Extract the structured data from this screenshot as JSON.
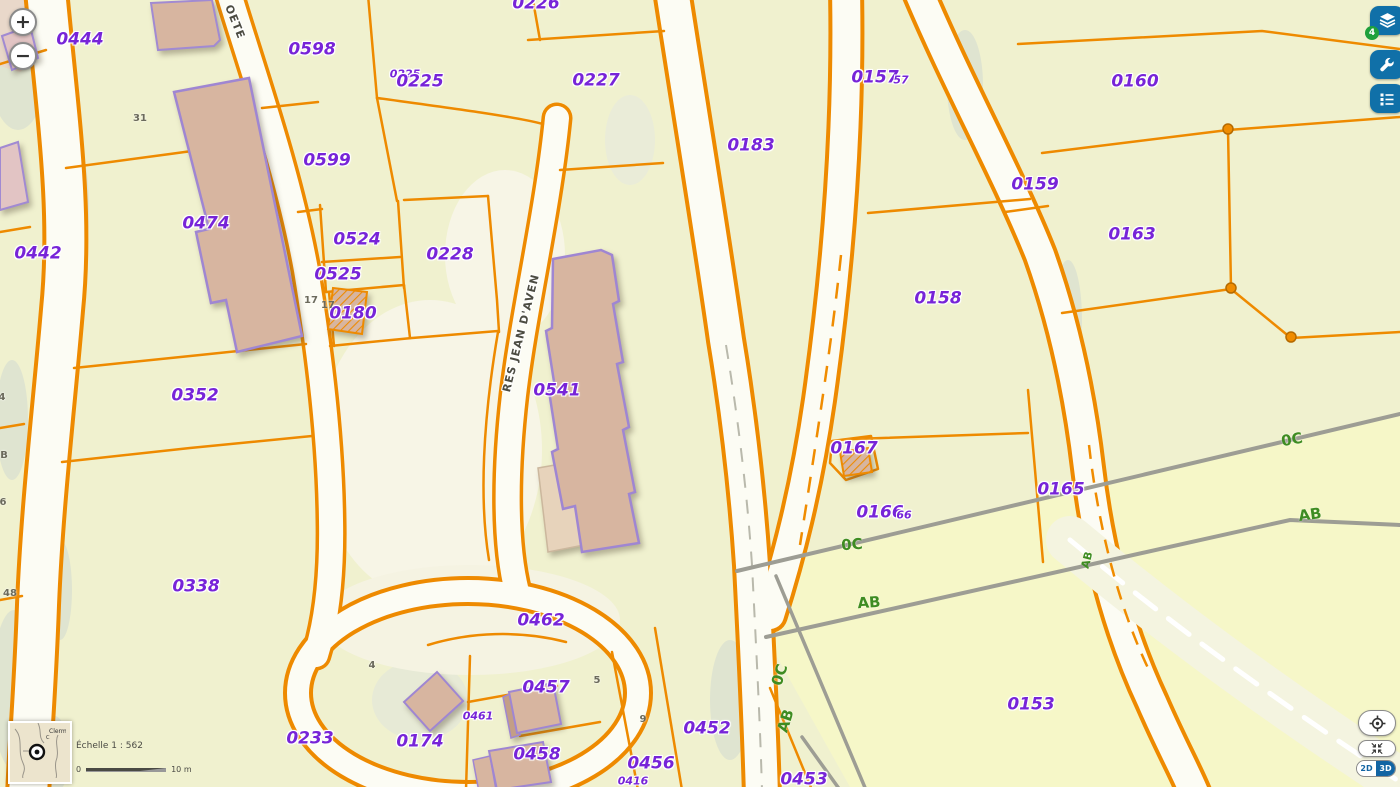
{
  "map": {
    "background": "#f0f1cf",
    "parcel_line_color": "#ee8a00",
    "parcel_label_color": "#7724d8",
    "section_label_color": "#3e8c22",
    "building_fill": "#d7b5a0",
    "building_outline": "#9f86d2",
    "section_line_color": "#9d9d94",
    "labels": [
      {
        "t": "0444",
        "x": 80,
        "y": 40,
        "k": "p"
      },
      {
        "t": "0598",
        "x": 312,
        "y": 50,
        "k": "p"
      },
      {
        "t": "0226",
        "x": 536,
        "y": 4,
        "k": "p"
      },
      {
        "t": "0225",
        "x": 405,
        "y": 74,
        "k": "ps"
      },
      {
        "t": "0225",
        "x": 420,
        "y": 82,
        "k": "p"
      },
      {
        "t": "0227",
        "x": 596,
        "y": 81,
        "k": "p"
      },
      {
        "t": "0157",
        "x": 875,
        "y": 78,
        "k": "p"
      },
      {
        "t": "57",
        "x": 901,
        "y": 80,
        "k": "ps"
      },
      {
        "t": "0160",
        "x": 1135,
        "y": 82,
        "k": "p"
      },
      {
        "t": "0183",
        "x": 751,
        "y": 146,
        "k": "p"
      },
      {
        "t": "0599",
        "x": 327,
        "y": 161,
        "k": "p"
      },
      {
        "t": "0159",
        "x": 1035,
        "y": 185,
        "k": "p"
      },
      {
        "t": "0474",
        "x": 206,
        "y": 224,
        "k": "p"
      },
      {
        "t": "0163",
        "x": 1132,
        "y": 235,
        "k": "p"
      },
      {
        "t": "0524",
        "x": 357,
        "y": 240,
        "k": "p"
      },
      {
        "t": "0228",
        "x": 450,
        "y": 255,
        "k": "p"
      },
      {
        "t": "0525",
        "x": 338,
        "y": 275,
        "k": "p"
      },
      {
        "t": "0158",
        "x": 938,
        "y": 299,
        "k": "p"
      },
      {
        "t": "0180",
        "x": 353,
        "y": 314,
        "k": "p"
      },
      {
        "t": "0442",
        "x": 38,
        "y": 254,
        "k": "p"
      },
      {
        "t": "0352",
        "x": 195,
        "y": 396,
        "k": "p"
      },
      {
        "t": "0541",
        "x": 557,
        "y": 391,
        "k": "p"
      },
      {
        "t": "0167",
        "x": 854,
        "y": 449,
        "k": "p"
      },
      {
        "t": "0165",
        "x": 1061,
        "y": 490,
        "k": "p"
      },
      {
        "t": "0166",
        "x": 880,
        "y": 513,
        "k": "p"
      },
      {
        "t": "66",
        "x": 904,
        "y": 515,
        "k": "ps"
      },
      {
        "t": "0338",
        "x": 196,
        "y": 587,
        "k": "p"
      },
      {
        "t": "0462",
        "x": 541,
        "y": 621,
        "k": "p"
      },
      {
        "t": "0457",
        "x": 546,
        "y": 688,
        "k": "p"
      },
      {
        "t": "0461",
        "x": 478,
        "y": 716,
        "k": "ps"
      },
      {
        "t": "0174",
        "x": 420,
        "y": 742,
        "k": "p"
      },
      {
        "t": "0233",
        "x": 310,
        "y": 739,
        "k": "p"
      },
      {
        "t": "0452",
        "x": 707,
        "y": 729,
        "k": "p"
      },
      {
        "t": "0458",
        "x": 537,
        "y": 755,
        "k": "p"
      },
      {
        "t": "0456",
        "x": 651,
        "y": 764,
        "k": "p"
      },
      {
        "t": "0416",
        "x": 633,
        "y": 781,
        "k": "ps"
      },
      {
        "t": "0453",
        "x": 804,
        "y": 780,
        "k": "p"
      },
      {
        "t": "0153",
        "x": 1031,
        "y": 705,
        "k": "p"
      },
      {
        "t": "31",
        "x": 140,
        "y": 119,
        "k": "g"
      },
      {
        "t": "17",
        "x": 311,
        "y": 301,
        "k": "g"
      },
      {
        "t": "17",
        "x": 328,
        "y": 306,
        "k": "g"
      },
      {
        "t": "4",
        "x": 372,
        "y": 666,
        "k": "g"
      },
      {
        "t": "4",
        "x": 2,
        "y": 398,
        "k": "g"
      },
      {
        "t": "B",
        "x": 4,
        "y": 456,
        "k": "g"
      },
      {
        "t": "6",
        "x": 3,
        "y": 503,
        "k": "g"
      },
      {
        "t": "48",
        "x": 10,
        "y": 594,
        "k": "g"
      },
      {
        "t": "5",
        "x": 597,
        "y": 681,
        "k": "g"
      },
      {
        "t": "9",
        "x": 643,
        "y": 720,
        "k": "g"
      },
      {
        "t": "0C",
        "x": 852,
        "y": 545,
        "k": "gr",
        "r": -4
      },
      {
        "t": "AB",
        "x": 869,
        "y": 603,
        "k": "gr",
        "r": -4
      },
      {
        "t": "0C",
        "x": 1292,
        "y": 440,
        "k": "gr",
        "r": -10
      },
      {
        "t": "AB",
        "x": 1310,
        "y": 515,
        "k": "gr",
        "r": -8
      },
      {
        "t": "AB",
        "x": 1087,
        "y": 560,
        "k": "grs",
        "r": -75
      },
      {
        "t": "0C",
        "x": 780,
        "y": 675,
        "k": "gr",
        "r": -72
      },
      {
        "t": "AB",
        "x": 786,
        "y": 721,
        "k": "gr",
        "r": -72
      },
      {
        "t": "OETE",
        "x": 235,
        "y": 22,
        "k": "st",
        "r": 68
      },
      {
        "t": "RES JEAN D'AVEN",
        "x": 521,
        "y": 333,
        "k": "st",
        "r": -76
      }
    ]
  },
  "controls": {
    "zoom_in": "+",
    "zoom_out": "−",
    "layers_count": "4",
    "view_2d": "2D",
    "view_3d": "3D"
  },
  "scalebar": {
    "label": "Échelle 1 : 562",
    "start": "0",
    "end": "10 m"
  },
  "minimap": {
    "place": "Clerm",
    "place_abbr": "C"
  }
}
